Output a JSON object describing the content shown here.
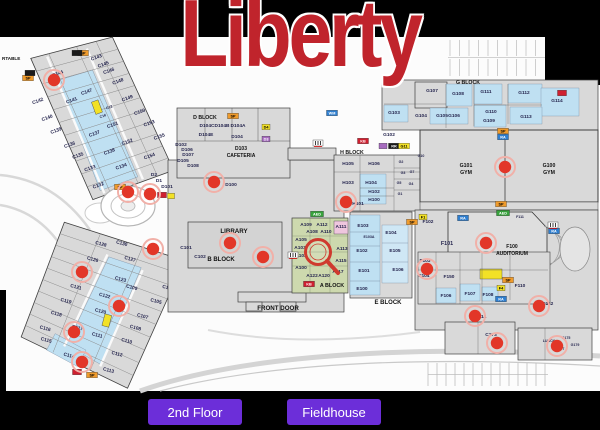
{
  "title": "Liberty",
  "buttons": {
    "second_floor": "2nd Floor",
    "fieldhouse": "Fieldhouse"
  },
  "colors": {
    "background": "#000000",
    "title_red": "#c0242c",
    "button_purple": "#6c2ed9",
    "paper": "#fcfcfc",
    "building": "#d9d9d9",
    "room_blue": "#bfe0f2",
    "block_green": "#cdd9ae",
    "marker_red": "#e23628",
    "tag_orange": "#ef9b2c",
    "tag_yellow": "#f2e126",
    "tag_blue": "#2f7fd0",
    "tag_green": "#37a23c",
    "tag_red": "#cf2030",
    "tag_purple": "#a66bbf",
    "label_ink": "#26264f"
  },
  "map": {
    "wing_a": {
      "rooms": [
        {
          "t": "C144",
          "x": 30,
          "y": 29
        },
        {
          "t": "C143",
          "x": 72,
          "y": 27
        },
        {
          "t": "C145",
          "x": 76,
          "y": 36
        },
        {
          "t": "C146",
          "x": 79,
          "y": 44
        },
        {
          "t": "C148",
          "x": 84,
          "y": 57
        },
        {
          "t": "C149",
          "x": 87,
          "y": 76
        },
        {
          "t": "C150",
          "x": 94,
          "y": 93
        },
        {
          "t": "C153",
          "x": 99,
          "y": 107
        },
        {
          "t": "C155",
          "x": 104,
          "y": 123
        },
        {
          "t": "C147",
          "x": 51,
          "y": 56
        },
        {
          "t": "C151",
          "x": 64,
          "y": 96
        },
        {
          "t": "C152",
          "x": 72,
          "y": 117
        },
        {
          "t": "C154",
          "x": 88,
          "y": 138
        },
        {
          "t": "C141",
          "x": 34,
          "y": 59
        },
        {
          "t": "C137",
          "x": 44,
          "y": 98
        },
        {
          "t": "C138",
          "x": 52,
          "y": 120
        },
        {
          "t": "C134",
          "x": 58,
          "y": 138
        },
        {
          "t": "C142",
          "x": 2,
          "y": 48
        },
        {
          "t": "C140",
          "x": 5,
          "y": 67
        },
        {
          "t": "C139",
          "x": 9,
          "y": 82
        },
        {
          "t": "C136",
          "x": 17,
          "y": 100
        },
        {
          "t": "C135",
          "x": 21,
          "y": 113
        },
        {
          "t": "C133",
          "x": 28,
          "y": 129
        },
        {
          "t": "C132",
          "x": 30,
          "y": 148
        },
        {
          "t": "C12",
          "x": 67,
          "y": 78,
          "s": 3.6
        },
        {
          "t": "C16",
          "x": 58,
          "y": 84,
          "s": 3.6
        }
      ]
    },
    "wing_b": {
      "rooms": [
        {
          "t": "C130",
          "x": 53,
          "y": -1
        },
        {
          "t": "C128",
          "x": 33,
          "y": 5
        },
        {
          "t": "C127",
          "x": 65,
          "y": 12
        },
        {
          "t": "C126",
          "x": 29,
          "y": 22
        },
        {
          "t": "C123",
          "x": 61,
          "y": 34
        },
        {
          "t": "C109",
          "x": 74,
          "y": 39
        },
        {
          "t": "C121",
          "x": 20,
          "y": 53
        },
        {
          "t": "C122",
          "x": 50,
          "y": 54
        },
        {
          "t": "C119",
          "x": 14,
          "y": 69
        },
        {
          "t": "C120",
          "x": 50,
          "y": 70
        },
        {
          "t": "C118",
          "x": 8,
          "y": 84
        },
        {
          "t": "C111",
          "x": 53,
          "y": 94
        },
        {
          "t": "C116",
          "x": 1,
          "y": 101
        },
        {
          "t": "C117",
          "x": 32,
          "y": 92
        },
        {
          "t": "C115",
          "x": 5,
          "y": 112
        },
        {
          "t": "C114",
          "x": 31,
          "y": 121
        },
        {
          "t": "C113",
          "x": 73,
          "y": 125
        },
        {
          "t": "C112",
          "x": 77,
          "y": 107
        },
        {
          "t": "C110",
          "x": 83,
          "y": 92
        },
        {
          "t": "C108",
          "x": 88,
          "y": 77
        },
        {
          "t": "C107",
          "x": 92,
          "y": 64
        },
        {
          "t": "C105",
          "x": 101,
          "y": 46
        },
        {
          "t": "C104",
          "x": 109,
          "y": 30
        },
        {
          "t": "C103",
          "x": 113,
          "y": 14
        }
      ]
    },
    "rooms": [
      {
        "t": "D104C",
        "x": 207,
        "y": 127
      },
      {
        "t": "D104B",
        "x": 222,
        "y": 127
      },
      {
        "t": "D104A",
        "x": 238,
        "y": 127
      },
      {
        "t": "D104E",
        "x": 206,
        "y": 136
      },
      {
        "t": "D104",
        "x": 237,
        "y": 138
      },
      {
        "t": "D102",
        "x": 181,
        "y": 146
      },
      {
        "t": "D106",
        "x": 187,
        "y": 151
      },
      {
        "t": "D107",
        "x": 188,
        "y": 156
      },
      {
        "t": "D105",
        "x": 183,
        "y": 162
      },
      {
        "t": "D108",
        "x": 193,
        "y": 167
      },
      {
        "t": "D100",
        "x": 231,
        "y": 186
      },
      {
        "t": "D2",
        "x": 154,
        "y": 176
      },
      {
        "t": "D1",
        "x": 159,
        "y": 182
      },
      {
        "t": "D101",
        "x": 167,
        "y": 188
      },
      {
        "t": "C101",
        "x": 186,
        "y": 249
      },
      {
        "t": "C102",
        "x": 200,
        "y": 258
      },
      {
        "t": "A109",
        "x": 306,
        "y": 226
      },
      {
        "t": "A112",
        "x": 322,
        "y": 226
      },
      {
        "t": "A111",
        "x": 341,
        "y": 228
      },
      {
        "t": "A108",
        "x": 312,
        "y": 233
      },
      {
        "t": "A110",
        "x": 326,
        "y": 233
      },
      {
        "t": "A105",
        "x": 301,
        "y": 241
      },
      {
        "t": "A103",
        "x": 300,
        "y": 249
      },
      {
        "t": "A102",
        "x": 301,
        "y": 257
      },
      {
        "t": "A100",
        "x": 301,
        "y": 269
      },
      {
        "t": "A122",
        "x": 312,
        "y": 277
      },
      {
        "t": "A120",
        "x": 324,
        "y": 277
      },
      {
        "t": "A117",
        "x": 338,
        "y": 273
      },
      {
        "t": "A113",
        "x": 342,
        "y": 250
      },
      {
        "t": "A115",
        "x": 341,
        "y": 262
      },
      {
        "t": "E103",
        "x": 363,
        "y": 227
      },
      {
        "t": "E103A",
        "x": 369,
        "y": 238,
        "s": 3.6
      },
      {
        "t": "E102",
        "x": 362,
        "y": 252
      },
      {
        "t": "E101",
        "x": 364,
        "y": 272
      },
      {
        "t": "E100",
        "x": 362,
        "y": 290
      },
      {
        "t": "E104",
        "x": 391,
        "y": 234
      },
      {
        "t": "E105",
        "x": 395,
        "y": 252
      },
      {
        "t": "E106",
        "x": 398,
        "y": 271
      },
      {
        "t": "H105",
        "x": 348,
        "y": 165
      },
      {
        "t": "H106",
        "x": 374,
        "y": 165
      },
      {
        "t": "H103",
        "x": 348,
        "y": 184
      },
      {
        "t": "H104",
        "x": 371,
        "y": 184
      },
      {
        "t": "H102",
        "x": 374,
        "y": 193
      },
      {
        "t": "H100",
        "x": 374,
        "y": 201
      },
      {
        "t": "H101",
        "x": 358,
        "y": 205
      },
      {
        "t": "G2",
        "x": 401,
        "y": 163,
        "s": 3.6
      },
      {
        "t": "G7",
        "x": 412,
        "y": 173,
        "s": 3.6
      },
      {
        "t": "G3",
        "x": 403,
        "y": 174,
        "s": 3.6
      },
      {
        "t": "G5",
        "x": 399,
        "y": 184,
        "s": 3.6
      },
      {
        "t": "G4",
        "x": 411,
        "y": 185,
        "s": 3.6
      },
      {
        "t": "G1",
        "x": 400,
        "y": 195,
        "s": 3.6
      },
      {
        "t": "G10",
        "x": 421,
        "y": 157,
        "s": 3.6
      },
      {
        "t": "G107",
        "x": 432,
        "y": 92
      },
      {
        "t": "G108",
        "x": 458,
        "y": 95
      },
      {
        "t": "G111",
        "x": 486,
        "y": 93
      },
      {
        "t": "G112",
        "x": 524,
        "y": 94
      },
      {
        "t": "G114",
        "x": 557,
        "y": 102
      },
      {
        "t": "G110",
        "x": 491,
        "y": 113
      },
      {
        "t": "G109",
        "x": 489,
        "y": 122
      },
      {
        "t": "G113",
        "x": 526,
        "y": 118
      },
      {
        "t": "G103",
        "x": 394,
        "y": 114
      },
      {
        "t": "G104",
        "x": 421,
        "y": 117
      },
      {
        "t": "G105",
        "x": 442,
        "y": 117
      },
      {
        "t": "G106",
        "x": 454,
        "y": 117
      },
      {
        "t": "G102",
        "x": 389,
        "y": 136
      },
      {
        "t": "F102",
        "x": 428,
        "y": 223
      },
      {
        "t": "F101",
        "x": 447,
        "y": 245,
        "s": 5.4
      },
      {
        "t": "F103",
        "x": 425,
        "y": 262
      },
      {
        "t": "F104",
        "x": 424,
        "y": 277
      },
      {
        "t": "F150",
        "x": 449,
        "y": 278
      },
      {
        "t": "F106",
        "x": 446,
        "y": 297
      },
      {
        "t": "F107",
        "x": 470,
        "y": 295
      },
      {
        "t": "F108",
        "x": 488,
        "y": 296
      },
      {
        "t": "F110",
        "x": 520,
        "y": 287
      },
      {
        "t": "F111",
        "x": 520,
        "y": 218,
        "s": 3.6
      },
      {
        "t": "F112",
        "x": 548,
        "y": 305
      },
      {
        "t": "F114",
        "x": 481,
        "y": 318
      },
      {
        "t": "C173",
        "x": 491,
        "y": 336
      },
      {
        "t": "G175",
        "x": 566,
        "y": 339,
        "s": 3.6
      },
      {
        "t": "G177",
        "x": 560,
        "y": 350,
        "s": 3.6
      },
      {
        "t": "G179",
        "x": 575,
        "y": 346,
        "s": 3.6
      },
      {
        "t": "LUNCH",
        "x": 549,
        "y": 342,
        "s": 3.6
      }
    ],
    "labels": [
      {
        "t": "D BLOCK",
        "x": 205,
        "y": 119,
        "s": 5.2
      },
      {
        "t": "H BLOCK",
        "x": 352,
        "y": 154,
        "s": 5.2
      },
      {
        "t": "G BLOCK",
        "x": 468,
        "y": 84,
        "s": 5.2
      },
      {
        "t": "B BLOCK",
        "x": 221,
        "y": 261,
        "s": 6
      },
      {
        "t": "E BLOCK",
        "x": 388,
        "y": 304,
        "s": 6
      },
      {
        "t": "A BLOCK",
        "x": 332,
        "y": 287,
        "s": 5.4
      },
      {
        "t": "LIBRARY",
        "x": 234,
        "y": 233,
        "s": 6.2
      },
      {
        "t": "FRONT DOOR",
        "x": 278,
        "y": 310,
        "s": 6.2
      },
      {
        "t": "G101",
        "x": 466,
        "y": 167,
        "s": 5.2
      },
      {
        "t": "GYM",
        "x": 466,
        "y": 174,
        "s": 5.2
      },
      {
        "t": "G100",
        "x": 549,
        "y": 167,
        "s": 5.2
      },
      {
        "t": "GYM",
        "x": 549,
        "y": 174,
        "s": 5.2
      },
      {
        "t": "D103",
        "x": 241,
        "y": 150,
        "s": 5
      },
      {
        "t": "CAFETERIA",
        "x": 241,
        "y": 157,
        "s": 5
      },
      {
        "t": "F100",
        "x": 512,
        "y": 248,
        "s": 5
      },
      {
        "t": "AUDITORIUM",
        "x": 512,
        "y": 255,
        "s": 5
      },
      {
        "t": "RTABLE",
        "x": 2,
        "y": 60,
        "s": 4.6,
        "a": "start"
      }
    ],
    "tags": [
      {
        "t": "SP",
        "x": 28,
        "y": 78,
        "bg": "#ef9b2c",
        "fg": "#000"
      },
      {
        "t": "SP",
        "x": 83,
        "y": 53,
        "bg": "#ef9b2c",
        "fg": "#000"
      },
      {
        "t": "SP",
        "x": 120,
        "y": 187,
        "bg": "#ef9b2c",
        "fg": "#000"
      },
      {
        "t": "SP",
        "x": 233,
        "y": 116,
        "bg": "#ef9b2c",
        "fg": "#000"
      },
      {
        "t": "SP",
        "x": 412,
        "y": 222,
        "bg": "#ef9b2c",
        "fg": "#000"
      },
      {
        "t": "SP",
        "x": 503,
        "y": 131,
        "bg": "#ef9b2c",
        "fg": "#000"
      },
      {
        "t": "SP",
        "x": 501,
        "y": 204,
        "bg": "#ef9b2c",
        "fg": "#000"
      },
      {
        "t": "SP",
        "x": 508,
        "y": 280,
        "bg": "#ef9b2c",
        "fg": "#000"
      },
      {
        "t": "SP",
        "x": 92,
        "y": 375,
        "bg": "#ef9b2c",
        "fg": "#000"
      },
      {
        "t": "RA",
        "x": 503,
        "y": 137,
        "bg": "#2f7fd0",
        "fg": "#fff"
      },
      {
        "t": "RA",
        "x": 463,
        "y": 218,
        "bg": "#2f7fd0",
        "fg": "#fff"
      },
      {
        "t": "RA",
        "x": 554,
        "y": 231,
        "bg": "#2f7fd0",
        "fg": "#fff"
      },
      {
        "t": "RA",
        "x": 501,
        "y": 299,
        "bg": "#2f7fd0",
        "fg": "#fff"
      },
      {
        "t": "WM",
        "x": 332,
        "y": 113,
        "bg": "#2f7fd0",
        "fg": "#fff"
      },
      {
        "t": "AED",
        "x": 317,
        "y": 214,
        "bg": "#37a23c",
        "fg": "#fff",
        "w": 13
      },
      {
        "t": "AED",
        "x": 503,
        "y": 213,
        "bg": "#37a23c",
        "fg": "#fff",
        "w": 13
      },
      {
        "t": "RR",
        "x": 394,
        "y": 146,
        "bg": "#1a1a1a",
        "fg": "#fff"
      },
      {
        "t": "",
        "x": 30,
        "y": 73,
        "bg": "#1a1a1a",
        "w": 10
      },
      {
        "t": "",
        "x": 77,
        "y": 53,
        "bg": "#1a1a1a",
        "w": 10
      },
      {
        "t": "KB",
        "x": 363,
        "y": 141,
        "bg": "#cf2030",
        "fg": "#fff"
      },
      {
        "t": "KB",
        "x": 309,
        "y": 284,
        "bg": "#cf2030",
        "fg": "#fff"
      },
      {
        "t": "",
        "x": 162,
        "y": 195,
        "bg": "#cf2030",
        "w": 9
      },
      {
        "t": "",
        "x": 77,
        "y": 372,
        "bg": "#cf2030",
        "w": 9
      },
      {
        "t": "",
        "x": 562,
        "y": 93,
        "bg": "#cf2030",
        "w": 9
      },
      {
        "t": "G11",
        "x": 404,
        "y": 146,
        "bg": "#f2e126",
        "fg": "#000"
      },
      {
        "t": "D4",
        "x": 266,
        "y": 127,
        "bg": "#f2e126",
        "fg": "#000",
        "w": 8
      },
      {
        "t": "D3",
        "x": 266,
        "y": 139,
        "bg": "#a66bbf",
        "fg": "#fff",
        "w": 8
      },
      {
        "t": "F1",
        "x": 423,
        "y": 217,
        "bg": "#f2e126",
        "fg": "#000",
        "w": 8
      },
      {
        "t": "F4",
        "x": 501,
        "y": 288,
        "bg": "#f2e126",
        "fg": "#000",
        "w": 8
      },
      {
        "t": "",
        "x": 171,
        "y": 196,
        "bg": "#f2e126",
        "w": 7
      },
      {
        "t": "",
        "x": 383,
        "y": 146,
        "bg": "#a66bbf",
        "w": 8
      }
    ],
    "markers": [
      [
        54,
        80
      ],
      [
        128,
        192
      ],
      [
        150,
        194
      ],
      [
        214,
        182
      ],
      [
        230,
        243
      ],
      [
        263,
        257
      ],
      [
        82,
        272
      ],
      [
        119,
        306
      ],
      [
        74,
        332
      ],
      [
        82,
        362
      ],
      [
        153,
        249
      ],
      [
        346,
        202
      ],
      [
        505,
        167
      ],
      [
        486,
        243
      ],
      [
        427,
        269
      ],
      [
        475,
        316
      ],
      [
        497,
        343
      ],
      [
        539,
        306
      ],
      [
        557,
        346
      ]
    ],
    "stairs": [
      [
        318,
        143
      ],
      [
        293,
        255
      ],
      [
        553,
        225
      ]
    ],
    "magnifier": {
      "x": 318,
      "y": 252
    }
  }
}
